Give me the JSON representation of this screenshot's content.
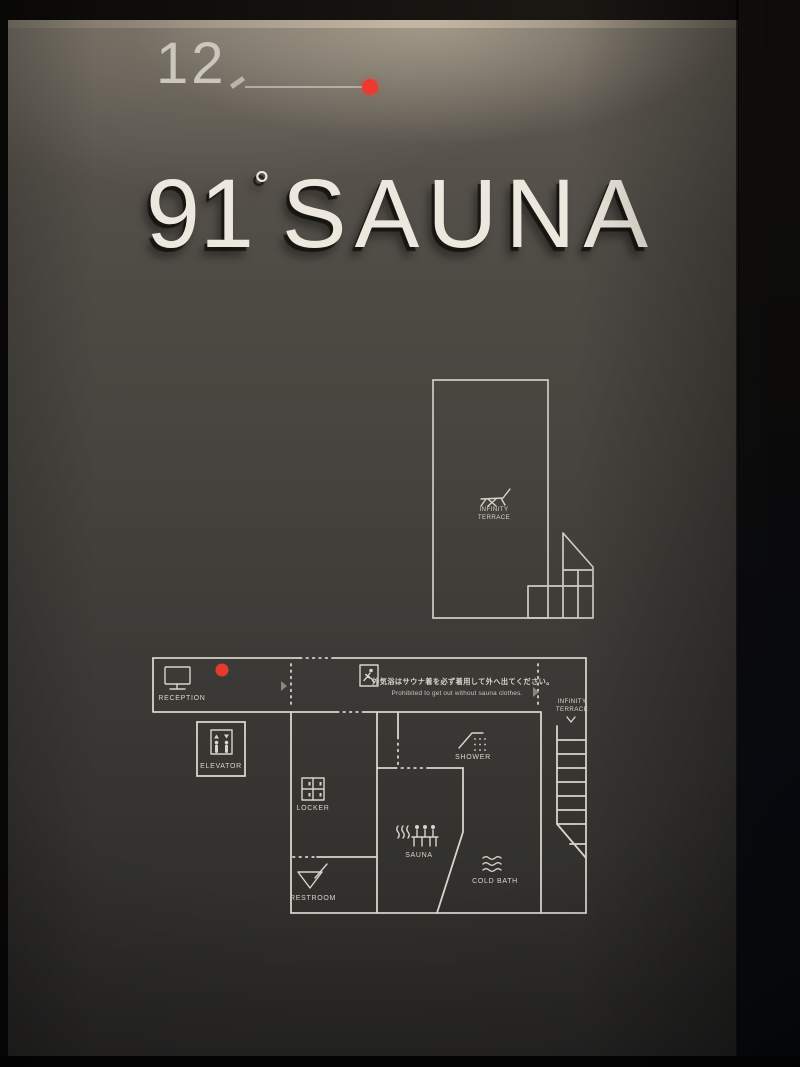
{
  "sign": {
    "floor_number": "12",
    "title_number": "91",
    "degree_symbol": "°",
    "title_word": "SAUNA"
  },
  "notice": {
    "jp": "外気浴はサウナ着を必ず着用して外へ出てください。",
    "en": "Prohibited to get out without sauna clothes."
  },
  "terrace_plan": {
    "label_line1": "INFINITY",
    "label_line2": "TERRACE"
  },
  "floor_plan": {
    "reception_label": "RECEPTION",
    "elevator_label": "ELEVATOR",
    "locker_label": "LOCKER",
    "restroom_label": "RESTROOM",
    "sauna_label": "SAUNA",
    "shower_label": "SHOWER",
    "cold_bath_label": "COLD BATH",
    "terrace_label_line1": "INFINITY",
    "terrace_label_line2": "TERRACE"
  },
  "colors": {
    "line": "#d8d4ca",
    "red_dot": "#e8392d",
    "panel_top": "#625d54",
    "panel_bottom": "#272625",
    "letters": "#ece8dd"
  },
  "icons": {
    "reception": "monitor-icon",
    "elevator": "elevator-icon",
    "locker": "locker-grid-icon",
    "restroom": "sink-icon",
    "sauna": "sauna-bench-icon",
    "shower": "shower-head-icon",
    "cold_bath": "waves-icon",
    "terrace": "lounge-chair-icon",
    "exit": "running-man-exit-icon",
    "location": "red-location-dot"
  }
}
